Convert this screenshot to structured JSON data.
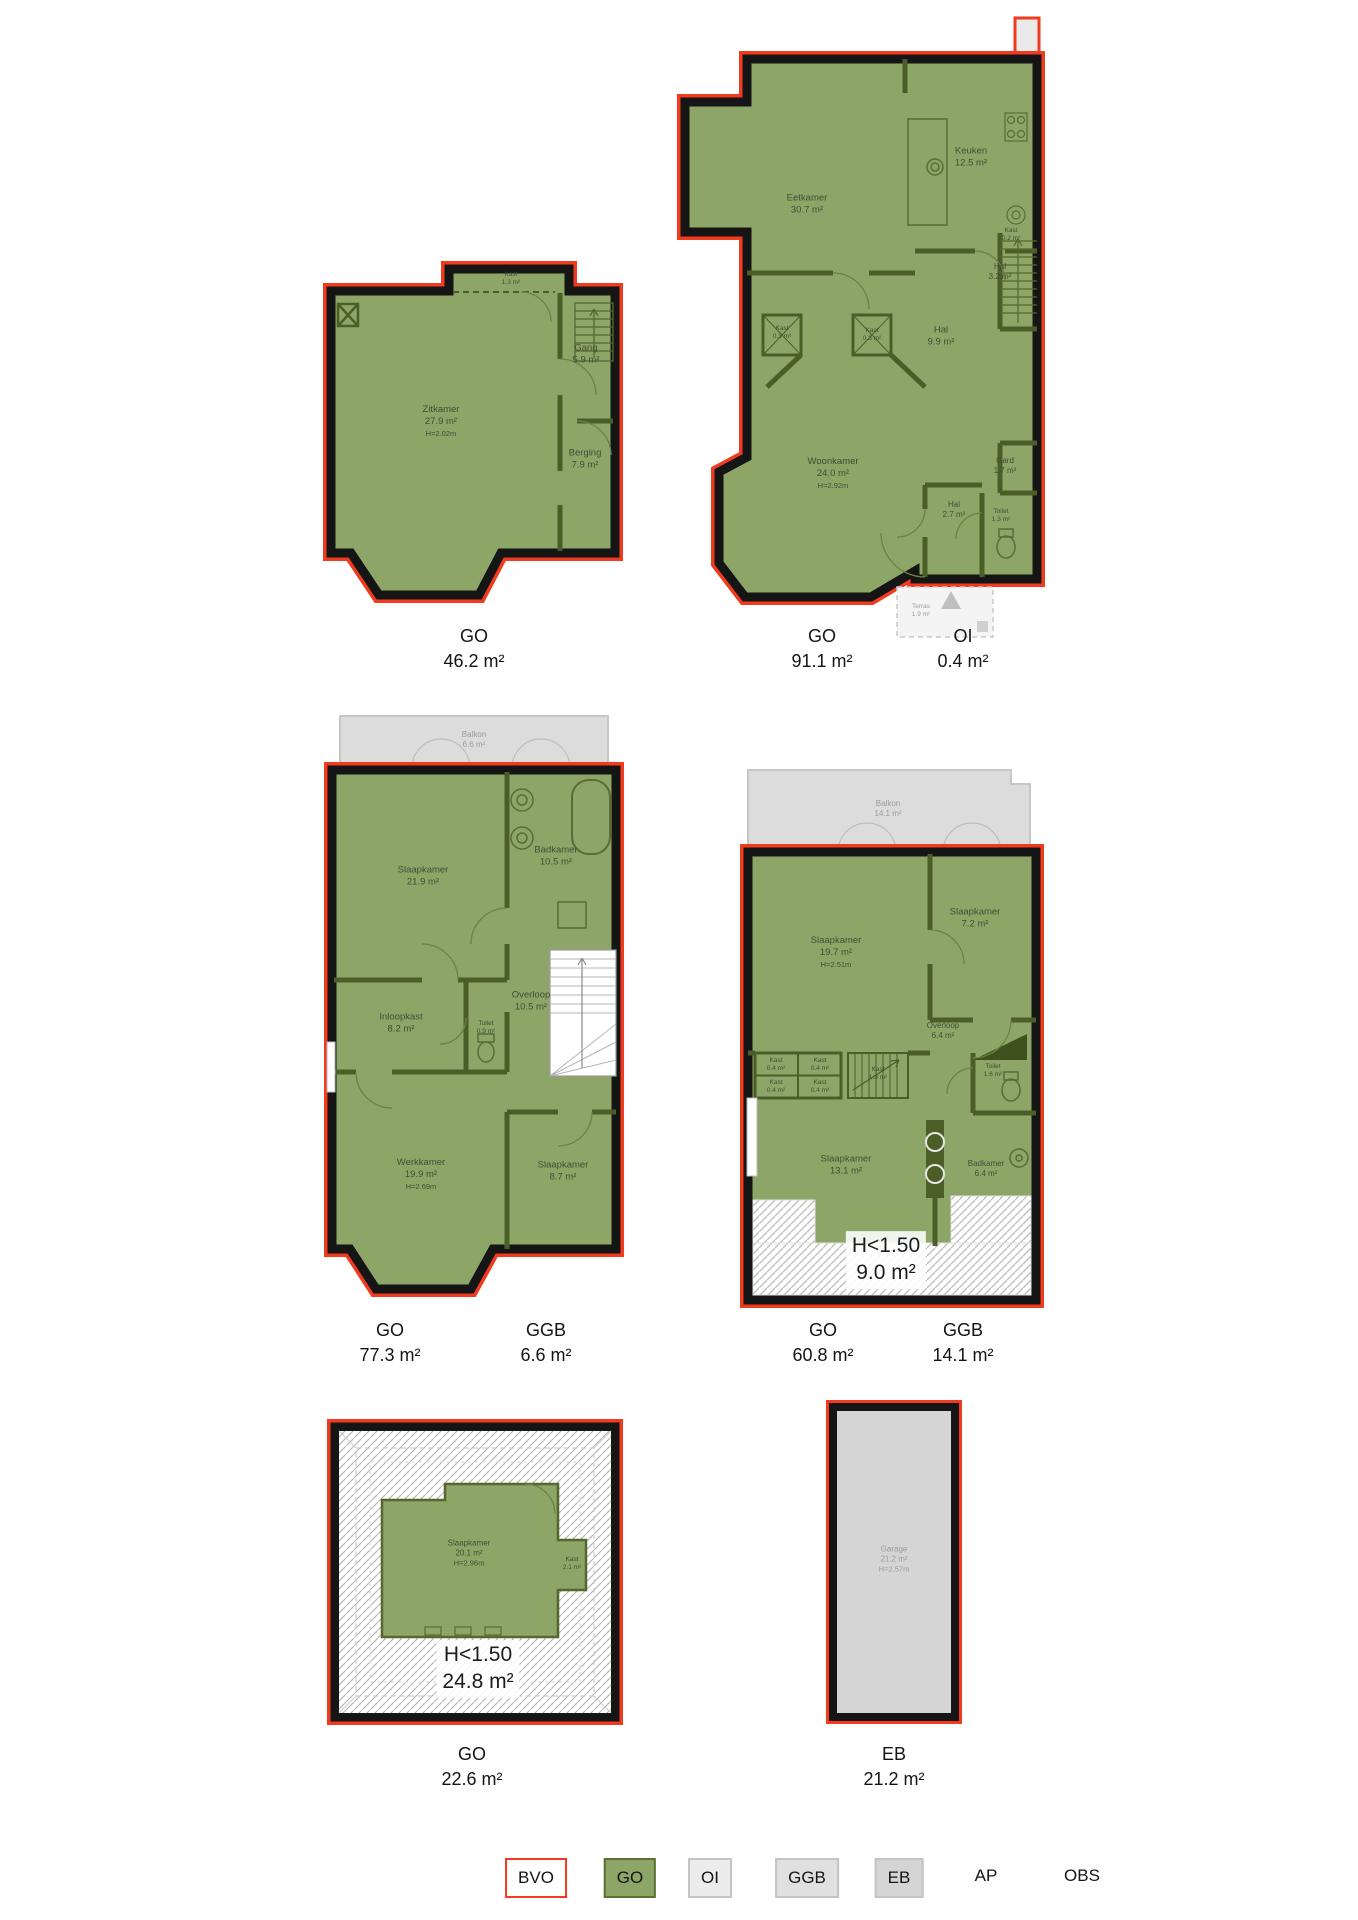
{
  "colors": {
    "outline_red": "#f23b1e",
    "wall_black": "#151515",
    "go_green": "#8da668",
    "partition_green": "#4c5e28",
    "gray_area": "#dcdcdc",
    "label_dark": "#141414"
  },
  "plans": [
    {
      "section_labels": [
        {
          "code": "GO",
          "value": "46.2 m²"
        }
      ],
      "rooms": {
        "kast": {
          "name": "Kast",
          "area": "1.3 m²"
        },
        "zitkamer": {
          "name": "Zitkamer",
          "area": "27.9 m²",
          "height": "H=2.02m"
        },
        "gang": {
          "name": "Gang",
          "area": "5.9 m²"
        },
        "berging": {
          "name": "Berging",
          "area": "7.9 m²"
        }
      }
    },
    {
      "section_labels": [
        {
          "code": "GO",
          "value": "91.1 m²"
        },
        {
          "code": "OI",
          "value": "0.4 m²"
        }
      ],
      "rooms": {
        "eetkamer": {
          "name": "Eetkamer",
          "area": "30.7 m²"
        },
        "keuken": {
          "name": "Keuken",
          "area": "12.5 m²"
        },
        "kast_klein": {
          "name": "Kast",
          "area": "0.2 m²"
        },
        "hal_boven": {
          "name": "Hal",
          "area": "3.2 m²"
        },
        "kast_links": {
          "name": "Kast",
          "area": "0.3 m²"
        },
        "kast_rechts": {
          "name": "Kast",
          "area": "0.3 m²"
        },
        "hal_midden": {
          "name": "Hal",
          "area": "9.9 m²"
        },
        "woonkamer": {
          "name": "Woonkamer",
          "area": "24.0 m²",
          "height": "H=2.92m"
        },
        "gard": {
          "name": "Gard",
          "area": "1.7 m²"
        },
        "hal_onder": {
          "name": "Hal",
          "area": "2.7 m²"
        },
        "toilet": {
          "name": "Toilet",
          "area": "1.3 m²"
        },
        "terras": {
          "name": "Terras",
          "area": "1.9 m²"
        }
      }
    },
    {
      "section_labels": [
        {
          "code": "GO",
          "value": "77.3 m²"
        },
        {
          "code": "GGB",
          "value": "6.6 m²"
        }
      ],
      "rooms": {
        "balkon": {
          "name": "Balkon",
          "area": "6.6 m²"
        },
        "slaapkamer_1": {
          "name": "Slaapkamer",
          "area": "21.9 m²"
        },
        "badkamer": {
          "name": "Badkamer",
          "area": "10.5 m²"
        },
        "inloopkast": {
          "name": "Inloopkast",
          "area": "8.2 m²"
        },
        "overloop": {
          "name": "Overloop",
          "area": "10.5 m²"
        },
        "toilet": {
          "name": "Toilet",
          "area": "0.9 m²"
        },
        "werkkamer": {
          "name": "Werkkamer",
          "area": "19.9 m²",
          "height": "H=2.69m"
        },
        "slaapkamer_2": {
          "name": "Slaapkamer",
          "area": "8.7 m²"
        }
      }
    },
    {
      "section_labels": [
        {
          "code": "GO",
          "value": "60.8 m²"
        },
        {
          "code": "GGB",
          "value": "14.1 m²"
        }
      ],
      "rooms": {
        "balkon": {
          "name": "Balkon",
          "area": "14.1 m²"
        },
        "slaapkamer_1": {
          "name": "Slaapkamer",
          "area": "19.7 m²",
          "height": "H=2.51m"
        },
        "slaapkamer_2": {
          "name": "Slaapkamer",
          "area": "7.2 m²"
        },
        "overloop": {
          "name": "Overloop",
          "area": "6.4 m²"
        },
        "kast_1": {
          "name": "Kast",
          "area": "0.4 m²"
        },
        "kast_2": {
          "name": "Kast",
          "area": "0.4 m²"
        },
        "kast_3": {
          "name": "Kast",
          "area": "0.4 m²"
        },
        "kast_4": {
          "name": "Kast",
          "area": "0.4 m²"
        },
        "kast_trap": {
          "name": "Kast",
          "area": "1.3 m²"
        },
        "toilet": {
          "name": "Toilet",
          "area": "1.6 m²"
        },
        "slaapkamer_3": {
          "name": "Slaapkamer",
          "area": "13.1 m²"
        },
        "badkamer": {
          "name": "Badkamer",
          "area": "6.4 m²"
        },
        "low_height": {
          "label": "H<1.50",
          "area": "9.0 m²"
        }
      }
    },
    {
      "section_labels": [
        {
          "code": "GO",
          "value": "22.6 m²"
        }
      ],
      "rooms": {
        "slaapkamer": {
          "name": "Slaapkamer",
          "area": "20.1 m²",
          "height": "H=2.96m"
        },
        "kast": {
          "name": "Kast",
          "area": "2.1 m²"
        },
        "low_height": {
          "label": "H<1.50",
          "area": "24.8 m²"
        }
      }
    },
    {
      "section_labels": [
        {
          "code": "EB",
          "value": "21.2 m²"
        }
      ],
      "rooms": {
        "garage": {
          "name": "Garage",
          "area": "21.2 m²",
          "height": "H=2.57m"
        }
      }
    }
  ],
  "legend": {
    "items": [
      {
        "label": "BVO",
        "fill": "#ffffff",
        "border": "#f23b1e"
      },
      {
        "label": "GO",
        "fill": "#8da668",
        "border": "#5d7036"
      },
      {
        "label": "OI",
        "fill": "#ececec",
        "border": "#c4c4c4"
      },
      {
        "label": "GGB",
        "fill": "#e0e0e0",
        "border": "#c4c4c4"
      },
      {
        "label": "EB",
        "fill": "#d4d4d4",
        "border": "#c0c0c0"
      },
      {
        "label": "AP",
        "fill": "",
        "border": ""
      },
      {
        "label": "OBS",
        "fill": "",
        "border": ""
      }
    ]
  }
}
